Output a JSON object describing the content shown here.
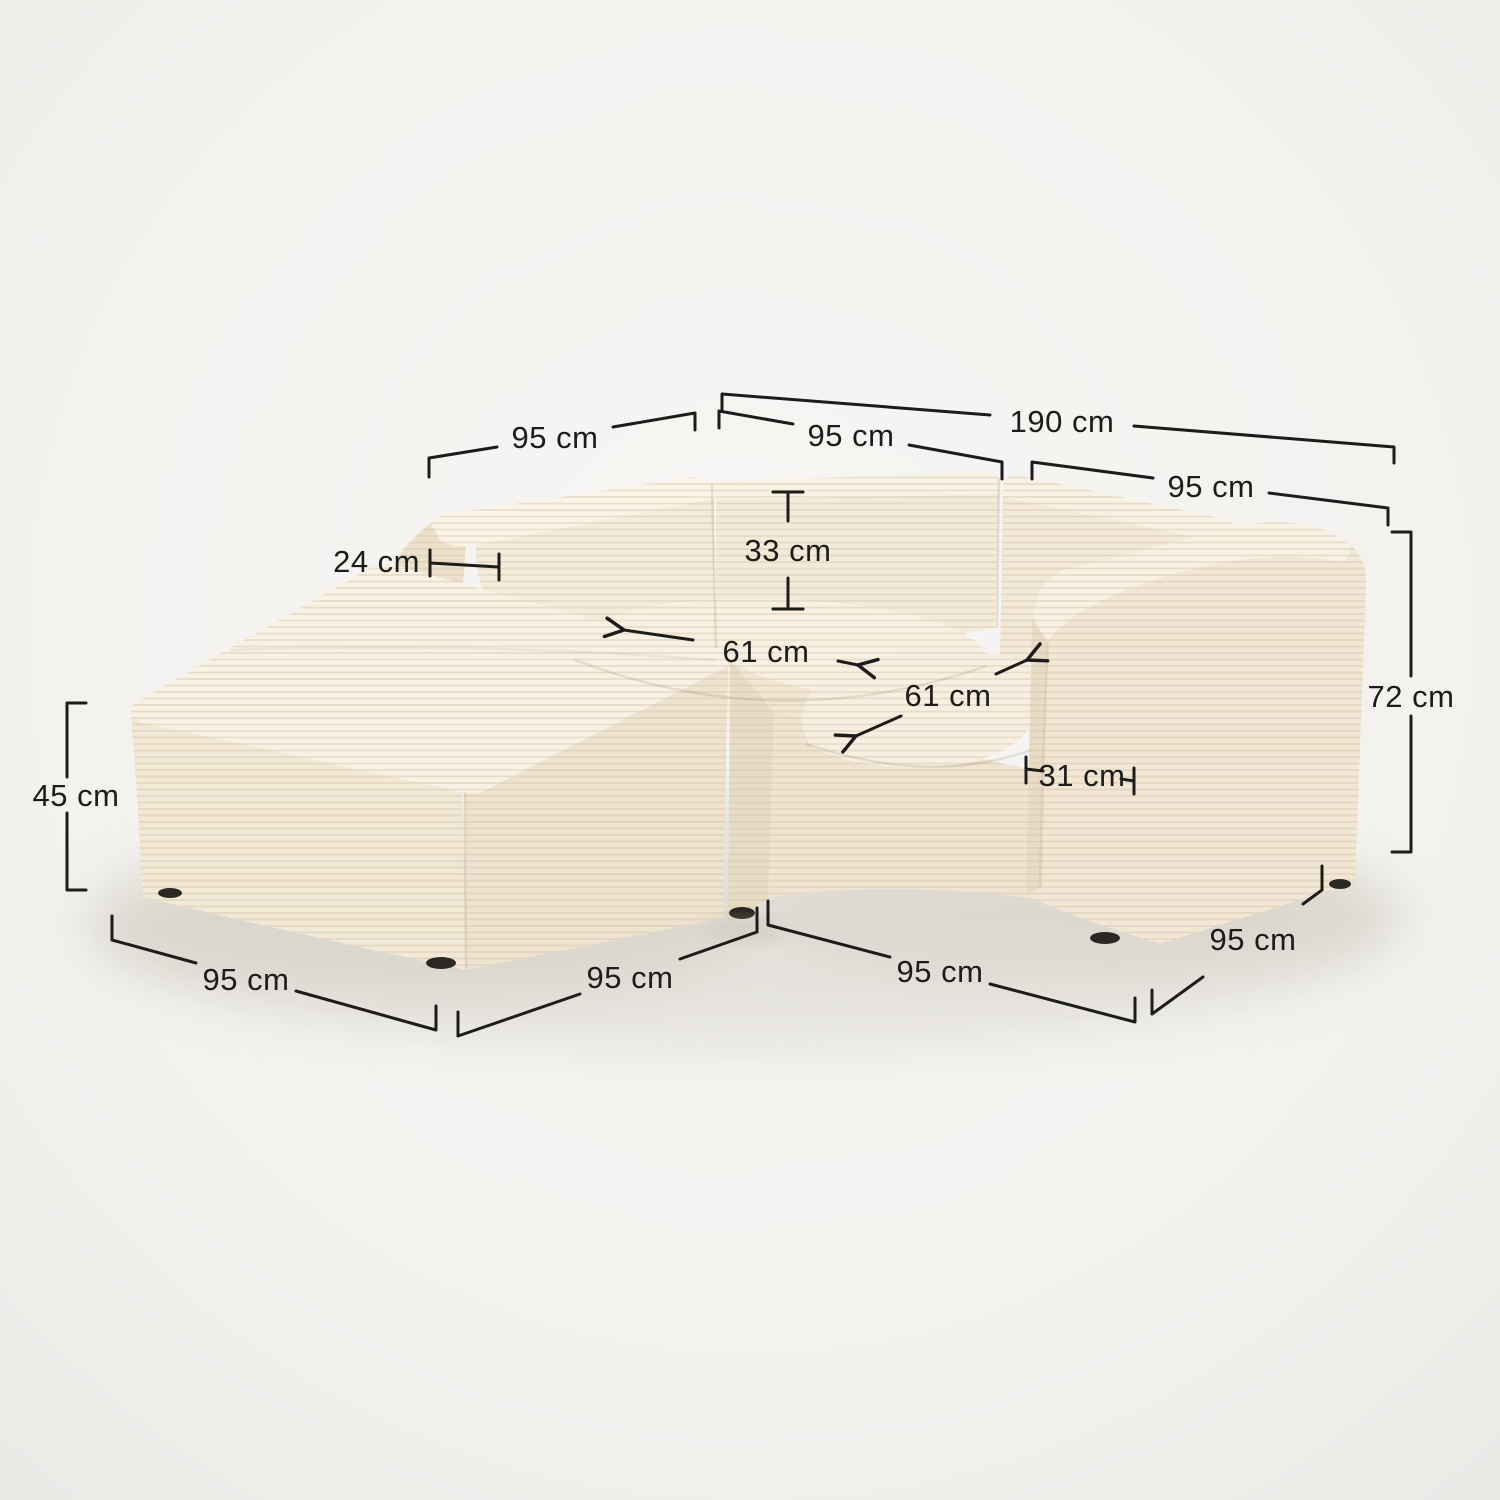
{
  "scene": {
    "description": "Cream corduroy modular corner sofa (two seat modules + ottoman) shown in three-quarter view with dimension annotations",
    "background_color": "#f2f1ee",
    "fabric_color": "#f6efe2",
    "annotation_color": "#1d1c1a",
    "unit": "cm"
  },
  "dimensions": {
    "total_width": {
      "label": "190 cm"
    },
    "back_left_depth": {
      "label": "95 cm"
    },
    "module_left_width": {
      "label": "95 cm"
    },
    "module_right_width": {
      "label": "95 cm"
    },
    "backrest_thickness": {
      "label": "24 cm"
    },
    "backrest_height": {
      "label": "33 cm"
    },
    "seat_depth_left": {
      "label": "61 cm"
    },
    "seat_depth_right": {
      "label": "61 cm"
    },
    "armrest_width": {
      "label": "31 cm"
    },
    "total_height": {
      "label": "72 cm"
    },
    "ottoman_height": {
      "label": "45 cm"
    },
    "ottoman_width": {
      "label": "95 cm"
    },
    "front_left_width": {
      "label": "95 cm"
    },
    "front_right_width": {
      "label": "95 cm"
    },
    "side_right_depth": {
      "label": "95 cm"
    }
  }
}
